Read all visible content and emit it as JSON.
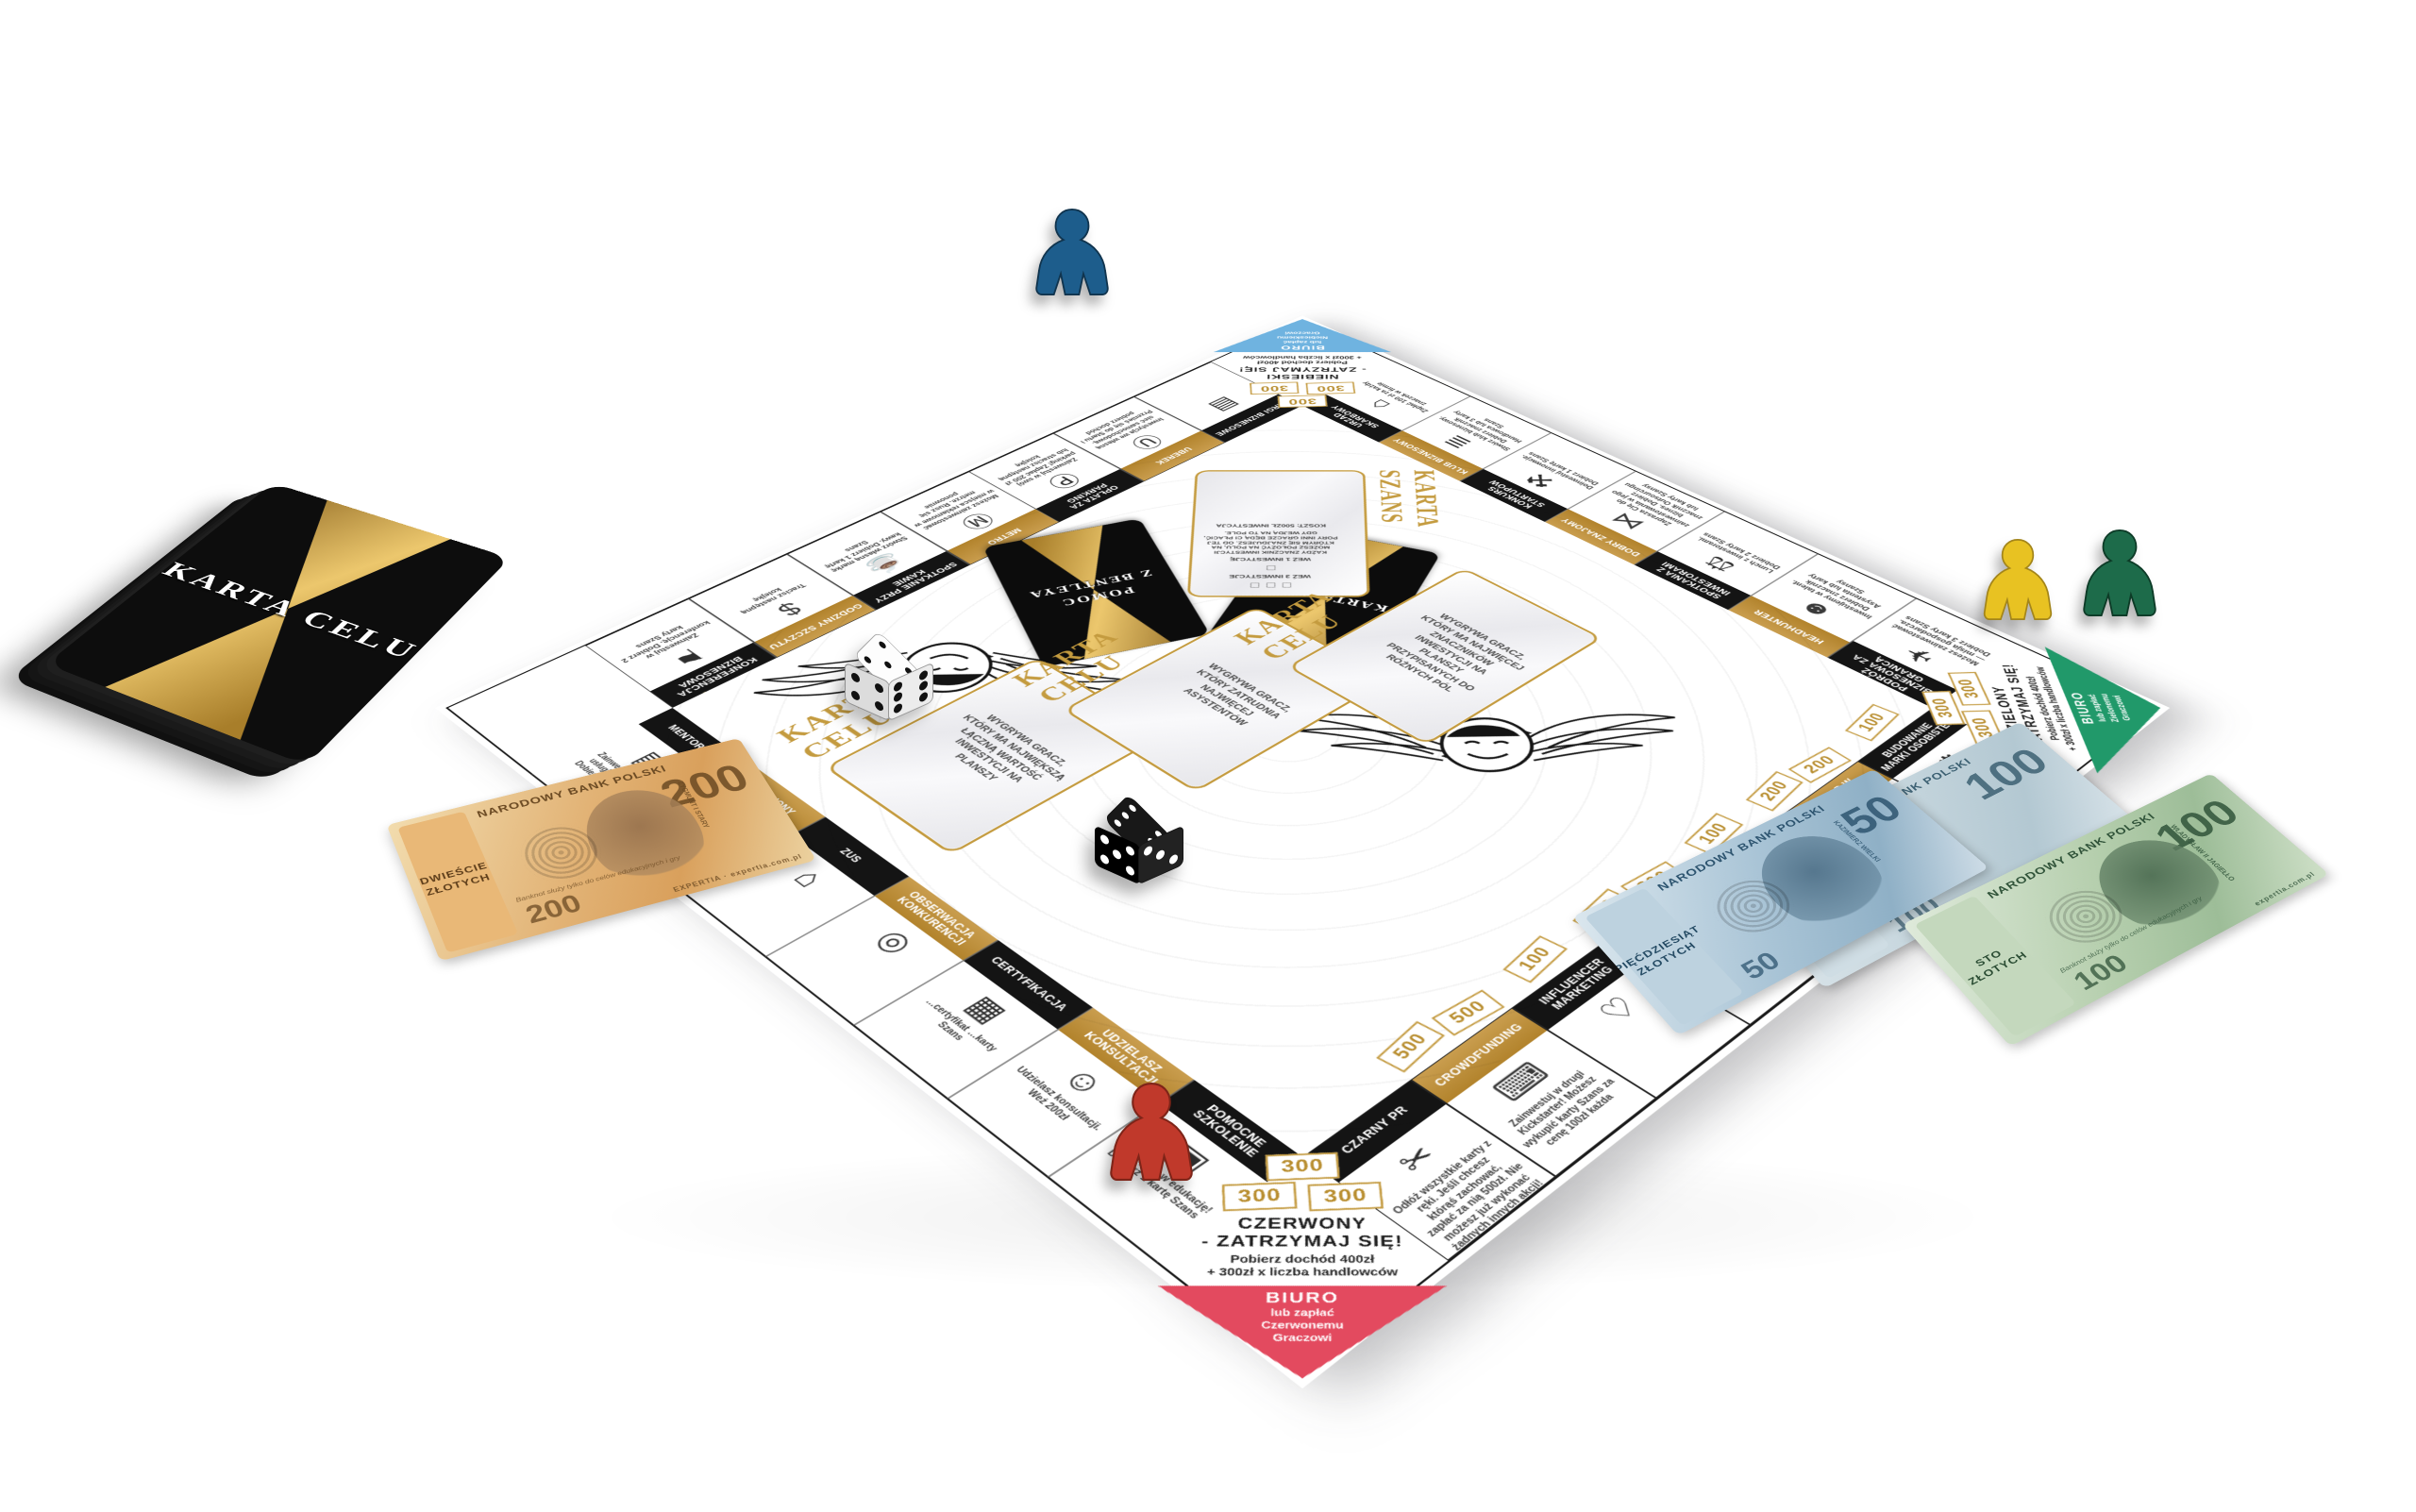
{
  "game": {
    "brand": "EXPERTIA",
    "deck": {
      "title": "KARTA CELU"
    }
  },
  "board": {
    "corners": {
      "blue": {
        "title": "NIEBIESKI\n- ZATRZYMAJ SIĘ!",
        "income": "Pobierz dochód 400zł\n+ 300zł x liczba handlowców",
        "biuro": "BIURO",
        "pay": "lub zapłać\nNiebieskiemu\nGraczowi",
        "badges": [
          "300",
          "300",
          "300"
        ],
        "color": "#6fb3e0"
      },
      "green": {
        "title": "ZIELONY\n- ZATRZYMAJ SIĘ!",
        "income": "Pobierz dochód 400zł\n+ 300zł x liczba handlowców",
        "biuro": "BIURO",
        "pay": "lub zapłać\nZielonemu\nGraczowi",
        "badges": [
          "300",
          "300",
          "300"
        ],
        "color": "#21996a"
      },
      "red": {
        "title": "CZERWONY\n- ZATRZYMAJ SIĘ!",
        "income": "Pobierz dochód 400zł\n+ 300zł x liczba handlowców",
        "biuro": "BIURO",
        "pay": "lub zapłać\nCzerwonemu\nGraczowi",
        "badges": [
          "300",
          "300",
          "300"
        ],
        "color": "#e34a5f"
      }
    },
    "top_row": [
      {
        "id": "konferencja-biznesowa",
        "label": "KONFERENCJA BIZNESOWA",
        "color": "black",
        "icon": "presentation",
        "desc": "Zainwestuj w konferencję. Dobierz 2 karty Szans",
        "badges": []
      },
      {
        "id": "godziny-szczytu",
        "label": "GODZINY SZCZYTU",
        "color": "gold",
        "icon": "coin",
        "desc": "Tracisz następną kolejkę",
        "badges": []
      },
      {
        "id": "spotkanie-przy-kawie",
        "label": "SPOTKANIE PRZY KAWIE",
        "color": "black",
        "icon": "coffee",
        "desc": "Stwórz własną markę kawy. Dobierz 1 kartę Szans",
        "badges": [
          "100"
        ]
      },
      {
        "id": "metro",
        "label": "METRO",
        "color": "gold",
        "icon": "metro",
        "desc": "Możesz zainwestować w miejsca reklamowe w metrze. Rusz się ponownie",
        "badges": [
          "300",
          "300"
        ]
      },
      {
        "id": "oplata-za-parking",
        "label": "OPŁATA ZA PARKING",
        "color": "black",
        "icon": "parking",
        "desc": "Zainwestuj w swój parking! Zapłać 200 zł lub stracisz następną kolejkę",
        "badges": [
          "100"
        ]
      },
      {
        "id": "uberek",
        "label": "UBEREK",
        "color": "gold",
        "icon": "car",
        "desc": "Inwestycja we własną sieć samochodową. Przenieś się do Startu i pobierz dochód",
        "badges": [
          "500",
          "500"
        ]
      },
      {
        "id": "targi-biznesowe",
        "label": "TARGI BIZNESOWE",
        "color": "black",
        "icon": "fair",
        "desc": "",
        "badges": [
          "100"
        ]
      }
    ],
    "right_col": [
      {
        "id": "urzad-skarbowy",
        "label": "URZĄD SKARBOWY",
        "color": "black",
        "icon": "bank",
        "desc": "Zapłać 100 zł za każdy znaczek w firmie",
        "badges": [
          "200",
          "200"
        ]
      },
      {
        "id": "klub-biznesowy",
        "label": "KLUB BIZNESOWY",
        "color": "gold",
        "icon": "money",
        "desc": "Stwórz klub biznesowy. Dobierz znacznik Handlowca lub 3 karty Szans",
        "badges": [
          "100"
        ]
      },
      {
        "id": "konkurs-startupow",
        "label": "KONKURS STARTUPÓW",
        "color": "black",
        "icon": "trolley",
        "desc": "Doinwestuj innowacje. Dobierz 1 kartę Szans",
        "badges": [
          "100"
        ]
      },
      {
        "id": "dobry-znajomy",
        "label": "DOBRY ZNAJOMY",
        "color": "gold",
        "icon": "handshake",
        "desc": "Zaprasza Cię do zainwestowania w jego biznes. Dobierz znacznik Outsourcingu lub karty Szansy",
        "badges": [
          "300",
          "300"
        ]
      },
      {
        "id": "spotkania-z-inwestorami",
        "label": "SPOTKANIA Z INWESTORAMI",
        "color": "black",
        "icon": "deal",
        "desc": "Lunch z inwestorami. Dobierz 2 karty Szans",
        "badges": [
          "100"
        ]
      },
      {
        "id": "headhunter",
        "label": "HEADHUNTER",
        "color": "gold",
        "icon": "head",
        "desc": "Inwestujemy w talent. Dobierz znacznik Asystenta lub karty Szansy",
        "badges": [
          "500",
          "500"
        ]
      },
      {
        "id": "podroz-biznesowa",
        "label": "PODRÓŻ BIZNESOWA ZA GRANICĄ",
        "color": "black",
        "icon": "globe",
        "desc": "Możesz zainwestować — misja gospodarcza. Dobierz 3 karty Szans",
        "badges": []
      }
    ],
    "bottom_row": [
      {
        "id": "czarny-pr",
        "label": "CZARNY PR",
        "color": "black",
        "icon": "scissors",
        "desc": "Odłóż wszystkie karty z ręki. Jeśli chcesz którąś zachować, zapłać za nią 500zł. Nie możesz już wykonać żadnych innych akcji!",
        "badges": []
      },
      {
        "id": "crowdfunding",
        "label": "CROWDFUNDING",
        "color": "gold",
        "icon": "keyboard",
        "desc": "Zainwestuj w drugi Kickstarter! Możesz wykupić karty Szans za cenę 100zł każda",
        "badges": [
          "500",
          "500"
        ]
      },
      {
        "id": "influencer-marketing",
        "label": "INFLUENCER MARKETING",
        "color": "black",
        "icon": "hands",
        "desc": "",
        "badges": [
          "100"
        ]
      },
      {
        "id": "wlasna-ksiazka",
        "label": "WŁASNA KSIĄŻKA",
        "color": "gold",
        "icon": "book",
        "desc": "Inwestycja w wiedzę",
        "badges": [
          "300",
          "300"
        ]
      },
      {
        "id": "marketing-twojej-firmy",
        "label": "MARKETING TWOJEJ FIRMY",
        "color": "black",
        "icon": "megaphone",
        "desc": "",
        "badges": [
          "100"
        ]
      },
      {
        "id": "wywiad-w-mediach",
        "label": "WYWIAD W MEDIACH",
        "color": "gold",
        "icon": "microphone",
        "desc": "Możesz zakupić akcje domów mediowych. Przesuń Bentleyem o 1 lub 2 pola w dowolnym kierunku i wykonaj akcję z pola",
        "badges": [
          "200",
          "200"
        ]
      },
      {
        "id": "budowanie-marki-osobistej",
        "label": "BUDOWANIE MARKI OSOBISTEJ",
        "color": "black",
        "icon": "gear",
        "desc": "Zainwestuj w swoją rozpoznawalność. Dobierz 1 kartę Szans",
        "badges": [
          "100"
        ]
      }
    ],
    "left_col": [
      {
        "id": "mentoring",
        "label": "MENTORING",
        "color": "black",
        "icon": "wallet",
        "desc": "Zainwestuj w rozwój usługi mentorskiej. Dobierz 3 karty Szans",
        "badges": [
          "100",
          "100"
        ]
      },
      {
        "id": "zarobiony",
        "label": "ZAROBIONY",
        "color": "gold",
        "icon": "scooter",
        "desc": "Szukasz rozwiązań biznesu u konkurencji. Zapłać każdemu Graczowi 100 zł",
        "badges": []
      },
      {
        "id": "zus",
        "label": "ZUS",
        "color": "black",
        "icon": "building",
        "desc": "",
        "badges": []
      },
      {
        "id": "obserwacja-konkurencji",
        "label": "OBSERWACJA KONKURENCJI",
        "color": "gold",
        "icon": "magnifier",
        "desc": "",
        "badges": [
          "300",
          "300"
        ]
      },
      {
        "id": "certyfikacja",
        "label": "CERTYFIKACJA",
        "color": "black",
        "icon": "certificate",
        "desc": "…certyfikat …karty Szans",
        "badges": [
          "100"
        ]
      },
      {
        "id": "udzielasz-konsultacji",
        "label": "UDZIELASZ KONSULTACJI",
        "color": "gold",
        "icon": "consult",
        "desc": "Udzielasz konsultacji. Weź 200zł",
        "badges": [
          "200",
          "200"
        ]
      },
      {
        "id": "pomocne-szkolenie",
        "label": "POMOCNE SZKOLENIE",
        "color": "black",
        "icon": "whiteboard",
        "desc": "Inwestycja w edukację! Dobierz 1 kartę Szans",
        "badges": [
          "100"
        ]
      }
    ],
    "center": {
      "slot_label": "KARTA CELU",
      "karta_celu_slots": [
        "WYGRYWA GRACZ, KTÓRY MA NAJWIĘKSZĄ ŁĄCZNĄ WARTOŚĆ INWESTYCJI NA PLANSZY",
        "WYGRYWA GRACZ, KTÓRY ZATRUDNIA NAJWIĘCEJ ASYSTENTÓW",
        "WYGRYWA GRACZ, KTÓRY MA NAJWIĘCEJ ZNACZNIKÓW INWESTYCJI NA PLANSZY PRZYPISANYCH DO RÓŻNYCH PÓL"
      ],
      "black_cards": [
        "POMOC\nZ BENTLEYA",
        "KARTA CELU"
      ],
      "szans": {
        "label": "KARTA SZANS",
        "squares3": "□ □ □",
        "squares1": "□",
        "line1": "WEŹ 3 INWESTYCJE",
        "line2": "WEŹ 1 INWESTYCJĘ",
        "body": "KAŻDY ZNACZNIK INWESTYCJI MOŻESZ POŁOŻYĆ NA POLU, NA KTÓRYM SIĘ ZNAJDUJESZ. OD TEJ PORY INNI GRACZE BĘDĄ CI PŁACIĆ, GDY WEJDĄ NA TO POLE.",
        "cost": "KOSZT: 500ZŁ INWESTYCJA"
      }
    }
  },
  "pieces": {
    "meeples": [
      {
        "id": "blue",
        "color": "#1d5d8c"
      },
      {
        "id": "red",
        "color": "#c0392b"
      },
      {
        "id": "yellow",
        "color": "#e8c222"
      },
      {
        "id": "green",
        "color": "#1d6b4a"
      }
    ],
    "dice": [
      {
        "id": "white",
        "faces_visible": [
          5,
          4,
          6
        ]
      },
      {
        "id": "black",
        "faces_visible": [
          6,
          5,
          3
        ]
      }
    ]
  },
  "money": {
    "n200": {
      "value": "200",
      "denom": "DWIEŚCIE ZŁOTYCH",
      "bank": "NARODOWY BANK POLSKI",
      "king": "ZYGMUNT I STARY",
      "edu": "Banknot służy tylko do celów edukacyjnych i gry",
      "brand": "EXPERTIA · expertia.com.pl"
    },
    "n50": {
      "value": "50",
      "denom": "PIĘĆDZIESIĄT ZŁOTYCH",
      "bank": "NARODOWY BANK POLSKI",
      "king": "KAZIMIERZ WIELKI"
    },
    "n100b": {
      "value": "100",
      "denom": "STO ZŁOTYCH",
      "bank": "NARODOWY BANK POLSKI"
    },
    "n100g": {
      "value": "100",
      "denom": "STO ZŁOTYCH",
      "bank": "NARODOWY BANK POLSKI",
      "king": "WŁADYSŁAW II JAGIEŁŁO",
      "edu": "Banknot służy tylko do celów edukacyjnych i gry",
      "brand": "expertia.com.pl"
    }
  }
}
